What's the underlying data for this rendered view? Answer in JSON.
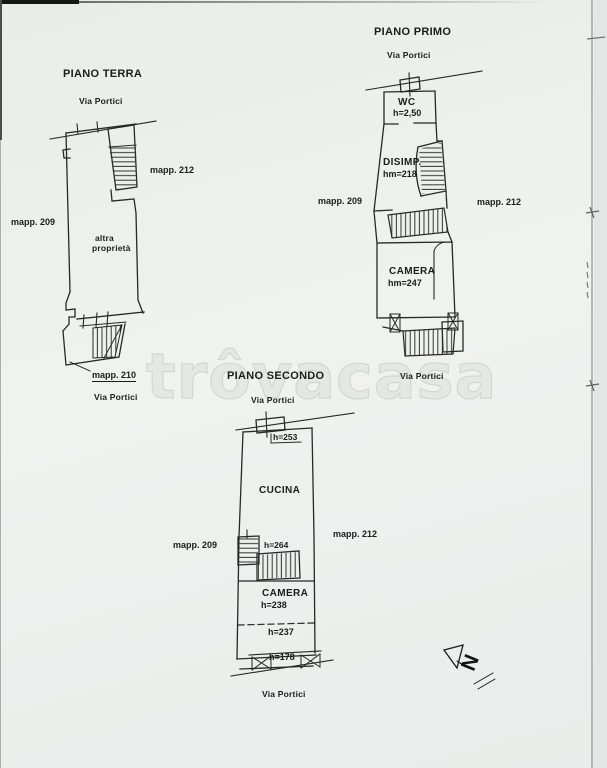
{
  "document": {
    "watermark": "trôvacasa",
    "north_label": "N"
  },
  "piano_terra": {
    "title": "PIANO TERRA",
    "street_top": "Via Portici",
    "street_bottom": "Via Portici",
    "parcel_left": "mapp. 209",
    "parcel_right": "mapp. 212",
    "parcel_bottom": "mapp. 210",
    "area_line1": "altra",
    "area_line2": "proprietà"
  },
  "piano_primo": {
    "title": "PIANO PRIMO",
    "street_top": "Via Portici",
    "street_bottom": "Via Portici",
    "parcel_left": "mapp. 209",
    "parcel_right": "mapp. 212",
    "wc_name": "WC",
    "wc_height": "h=2,50",
    "disimp_name": "DISIMP.",
    "disimp_height": "hm=218",
    "camera_name": "CAMERA",
    "camera_height": "hm=247"
  },
  "piano_secondo": {
    "title": "PIANO SECONDO",
    "street_top": "Via Portici",
    "street_bottom": "Via Portici",
    "parcel_left": "mapp. 209",
    "parcel_right": "mapp. 212",
    "height_top": "h=253",
    "cucina_name": "CUCINA",
    "stair_height": "h=264",
    "camera_name": "CAMERA",
    "camera_height": "h=238",
    "height_mid": "h=237",
    "height_bottom": "h=178"
  }
}
